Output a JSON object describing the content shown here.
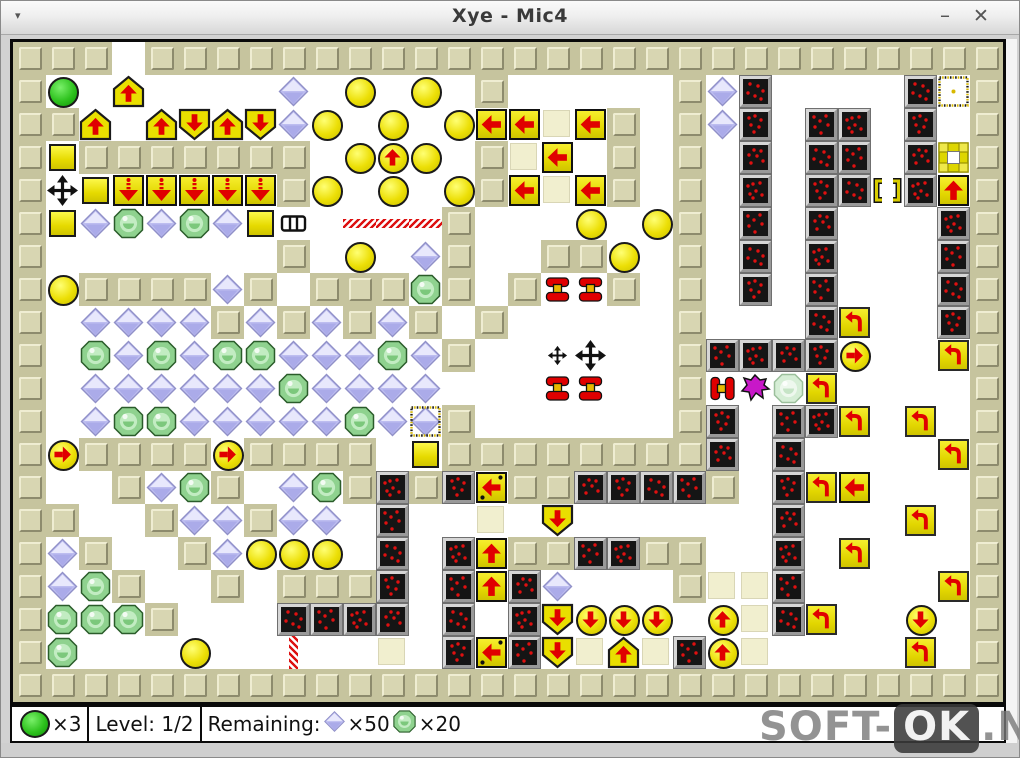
{
  "window": {
    "title": "Xye - Mic4",
    "menu_glyph": "▾",
    "minimize_glyph": "–",
    "close_glyph": "✕"
  },
  "status_bar": {
    "lives_count": "×3",
    "level_label": "Level: 1/2",
    "remaining_label": "Remaining:",
    "diamonds_remaining": "×50",
    "gems_remaining": "×20"
  },
  "watermark": {
    "part1": "SOFT-",
    "part2": "OK",
    "part3": ".NET"
  },
  "colors": {
    "wall": "#c6c49e",
    "yellow": "#e8e000",
    "red": "#e00000",
    "diamond": "#bdbdf0",
    "gem": "#8fd28f",
    "enemy": "#c818c8",
    "player": "#2ec21e",
    "mine": "#151515"
  },
  "board": {
    "cols": 30,
    "rows": 20,
    "tile_size": 33,
    "legend": {
      "#": "wall",
      ".": "floor",
      "P": "player-xye",
      "Y": "yellow-ball",
      "S": "yellow-box",
      "F": "faded-box",
      "D": "purple-diamond",
      "*": "purple-diamond-marked",
      "G": "green-gem",
      "p": "pale-gem",
      "B": "mine-box",
      "A": "one-way-house-up",
      "V": "one-way-house-down",
      "u": "arrow-block-up",
      "l": "arrow-block-left",
      "L": "arrow-block-left-dotted",
      "d": "arrow-block-down-dotted",
      "t": "turner-block",
      "^": "arrow-ball-up",
      "v": "arrow-ball-down",
      ">": "arrow-ball-right",
      "X": "mover-cross",
      "x": "mover-cross-small",
      "M": "magnet-horizontal",
      "m": "magnet-vertical",
      "E": "enemy",
      "H": "grill",
      "T": "teleport-marker",
      "O": "hollow-block",
      "K": "bracket-gate",
      "-": "hatch-horizontal",
      "|": "hatch-vertical"
    },
    "tiles": [
      "###.##########################",
      "#P.A....D.Y.Y.#.....#DB....BT#",
      "##A.AVAVDY.Y.YllFl#.#DB.BB.B.#",
      "#S#######.Y^Y.#Fl.#.#.B.BB.BO#",
      "#XSddddd#Y.Y.Y#lFl#.#.B.BBKBu#",
      "#SDGDGDSH.---#...Y.Y#.B.B...B#",
      "#.......#.Y.D#..##Y.#.B.B...B#",
      "#Y####D#.###G#.#mm#.#.B.B...B#",
      "#.DDDD#D#D#D#.#.....#...Bt..B#",
      "#.GDGDGGDDDGD#..xX..#BBBB>..t#",
      "#.DDDDDDGDDDD...mm..#MEpt....#",
      "#.DGGDDDDDGD*#......#B.BBt.t.#",
      "#>####>####.S########B.B....t#",
      "#..#DG#.DG#B#BL##BBBB#.Btl...#",
      "##..#DD#DD.B..F.V......B...t.#",
      "#D#..#DYYY.B.Bu##BB##..B.t...#",
      "#DG#..#.###B.BuBD...#FFB....t#",
      "#GGG#...BBBB.B.BVvvv.^FBt..v.#",
      "#G...Y..|..F.BLBVFAFB^F....t.#",
      "##############################"
    ]
  }
}
